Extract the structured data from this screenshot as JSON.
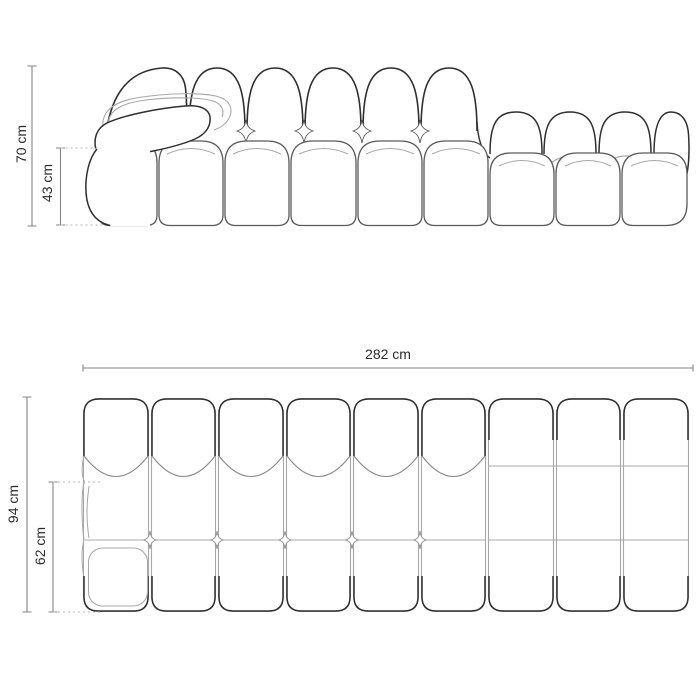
{
  "page": {
    "background": "#ffffff"
  },
  "drawing": {
    "subject": "modular-sofa-technical-drawing",
    "colors": {
      "outline": "#2f2f2f",
      "soft_line": "#5a5a5a",
      "secondary_line": "#a8a8a8",
      "tertiary_line": "#8a8a8a",
      "dimension_line": "#848484",
      "dotted_line": "#b5b5b5",
      "label_text": "#2b2b2b",
      "background": "#ffffff"
    },
    "front_view": {
      "dimensions": [
        {
          "id": "overall-height",
          "label": "70 cm"
        },
        {
          "id": "seat-height",
          "label": "43 cm"
        }
      ]
    },
    "plan_view": {
      "dimensions": [
        {
          "id": "overall-width",
          "label": "282 cm"
        },
        {
          "id": "overall-depth",
          "label": "94 cm"
        },
        {
          "id": "seat-depth",
          "label": "62 cm"
        }
      ]
    }
  }
}
